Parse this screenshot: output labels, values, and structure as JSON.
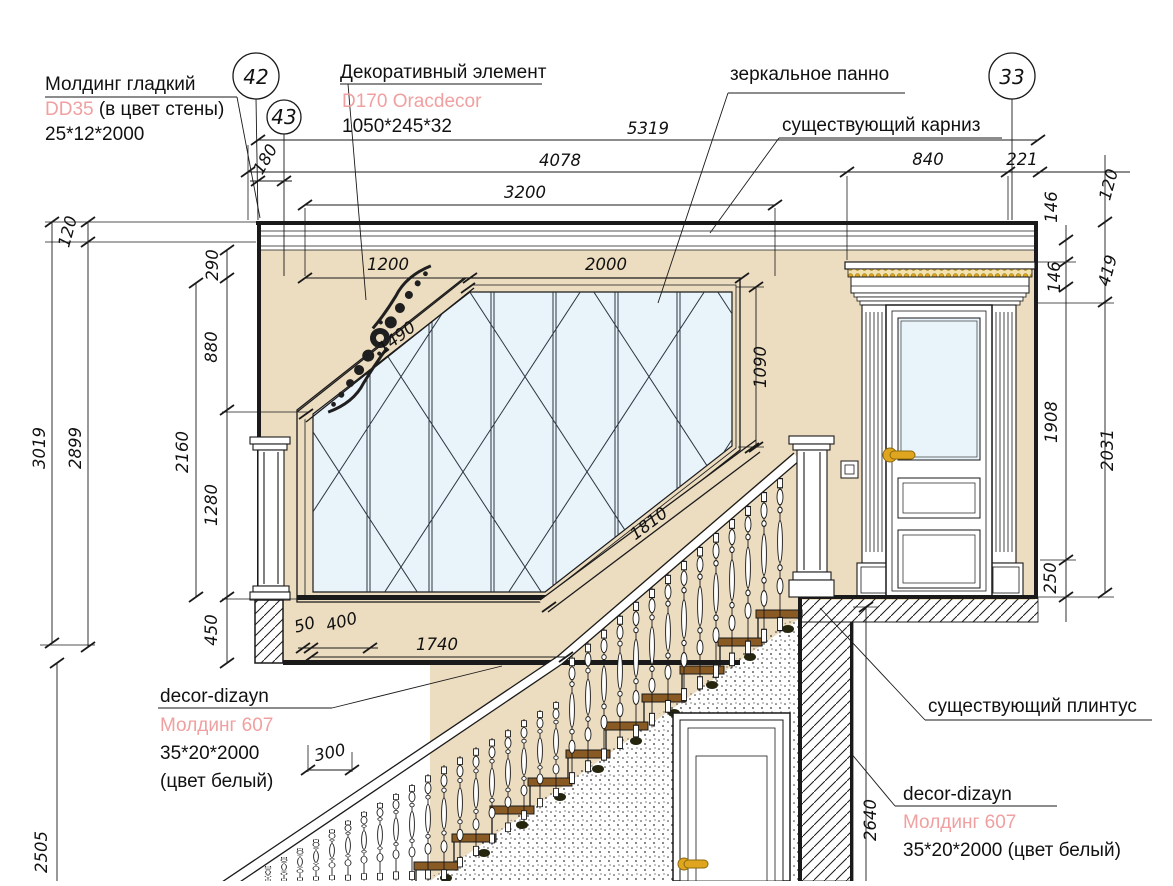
{
  "callouts": {
    "molding_top": {
      "title": "Молдинг гладкий",
      "code": "DD35",
      "code_suffix": " (в цвет стены)",
      "size": "25*12*2000"
    },
    "decorative": {
      "title": "Декоративный элемент",
      "code": "D170 Oracdecor",
      "size": "1050*245*32"
    },
    "mirror": {
      "label": "зеркальное панно"
    },
    "cornice": {
      "label": "существующий карниз"
    },
    "plinth": {
      "label": "существующий плинтус"
    },
    "molding_left": {
      "brand": "decor-dizayn",
      "code": "Молдинг 607",
      "size": "35*20*2000",
      "color": "(цвет белый)"
    },
    "molding_right": {
      "brand": "decor-dizayn",
      "code": "Молдинг 607",
      "size": "35*20*2000 (цвет белый)"
    }
  },
  "axes": {
    "a42": "42",
    "a43": "43",
    "a33": "33"
  },
  "dims": {
    "d5319": "5319",
    "d4078": "4078",
    "d3200": "3200",
    "d180": "180",
    "d840": "840",
    "d221": "221",
    "d120L": "120",
    "d3019": "3019",
    "d2899": "2899",
    "d290": "290",
    "d880": "880",
    "d2160": "2160",
    "d1280": "1280",
    "d450": "450",
    "d1200": "1200",
    "d2000": "2000",
    "d1490": "1490",
    "d1090": "1090",
    "d1810": "1810",
    "d146a": "146",
    "d146b": "146",
    "d120R": "120",
    "d419": "419",
    "d1908": "1908",
    "d2031": "2031",
    "d250": "250",
    "d50": "50",
    "d400": "400",
    "d1740": "1740",
    "d300": "300",
    "d2505": "2505",
    "d2640": "2640"
  },
  "colors": {
    "wall": "#ecdcc0",
    "glass": "#e9f3fa",
    "gold": "#e0a51f",
    "tread": "#8a5a24",
    "pink": "#f0a0a0",
    "line": "#1a1a1a"
  }
}
